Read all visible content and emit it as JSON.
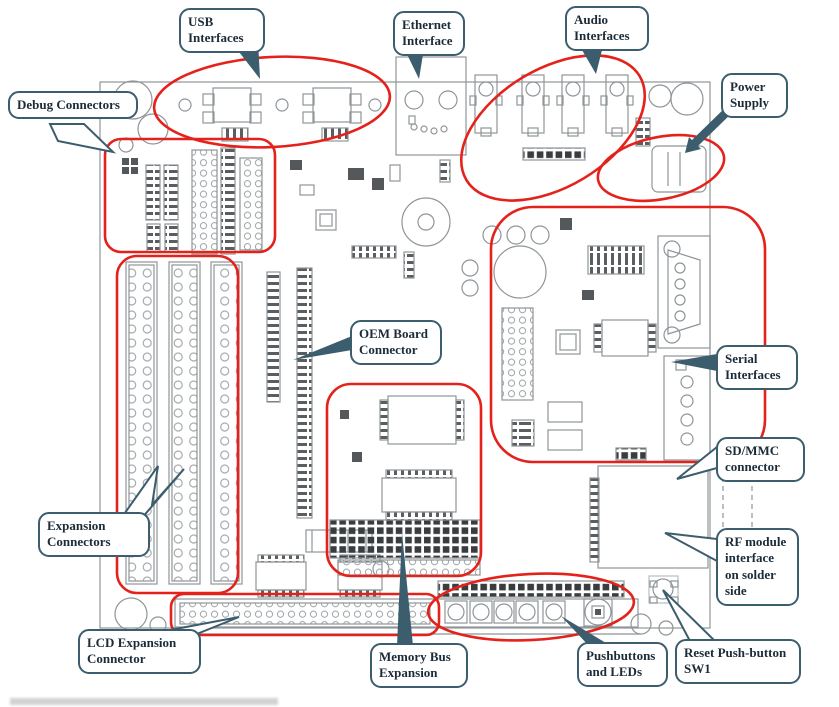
{
  "diagram": {
    "type": "annotated-pcb-board-diagram",
    "colors": {
      "highlight_red": "#e4221b",
      "callout_border": "#3b5d6e",
      "callout_text": "#1b2b38",
      "board_line": "#8f9598"
    },
    "callouts": {
      "usb": {
        "label": "USB\nInterfaces"
      },
      "ethernet": {
        "label": "Ethernet\nInterface"
      },
      "audio": {
        "label": "Audio\nInterfaces"
      },
      "power": {
        "label": "Power\nSupply"
      },
      "debug": {
        "label": "Debug Connectors"
      },
      "oem": {
        "label": "OEM Board\nConnector"
      },
      "serial": {
        "label": "Serial\nInterfaces"
      },
      "sdmmc": {
        "label": "SD/MMC\nconnector"
      },
      "expansion": {
        "label": "Expansion\nConnectors"
      },
      "rf": {
        "label": "RF module\ninterface\non solder\nside"
      },
      "lcd": {
        "label": "LCD Expansion\nConnector"
      },
      "memory": {
        "label": "Memory Bus\nExpansion"
      },
      "pushbuttons": {
        "label": "Pushbuttons\nand LEDs"
      },
      "reset": {
        "label": "Reset Push-button\nSW1"
      }
    }
  }
}
